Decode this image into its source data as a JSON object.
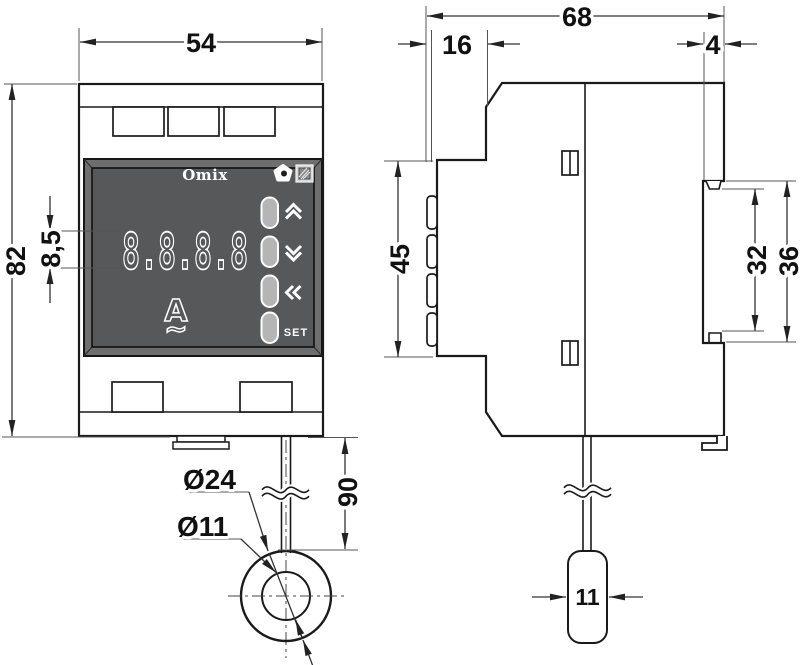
{
  "drawing": {
    "front_view": {
      "brand": "Omix",
      "display_value": "8.8.8.8",
      "unit": "A",
      "ac_symbol": "~",
      "set_button": "SET"
    },
    "dimensions": {
      "front_width": "54",
      "front_height": "82",
      "digit_height": "8,5",
      "total_depth": "68",
      "bezel_depth": "16",
      "din_lip_depth": "4",
      "bezel_height": "45",
      "din_slot_height": "32",
      "din_slot_full_height": "36",
      "cable_length": "90",
      "ct_outer_diameter": "Ø24",
      "ct_hole_diameter": "Ø11",
      "ct_body_width": "11"
    },
    "colors": {
      "panel": "#57585a",
      "frame": "#6e6e6e",
      "button": "#b5b5b5",
      "line": "#1a1a1a"
    }
  }
}
